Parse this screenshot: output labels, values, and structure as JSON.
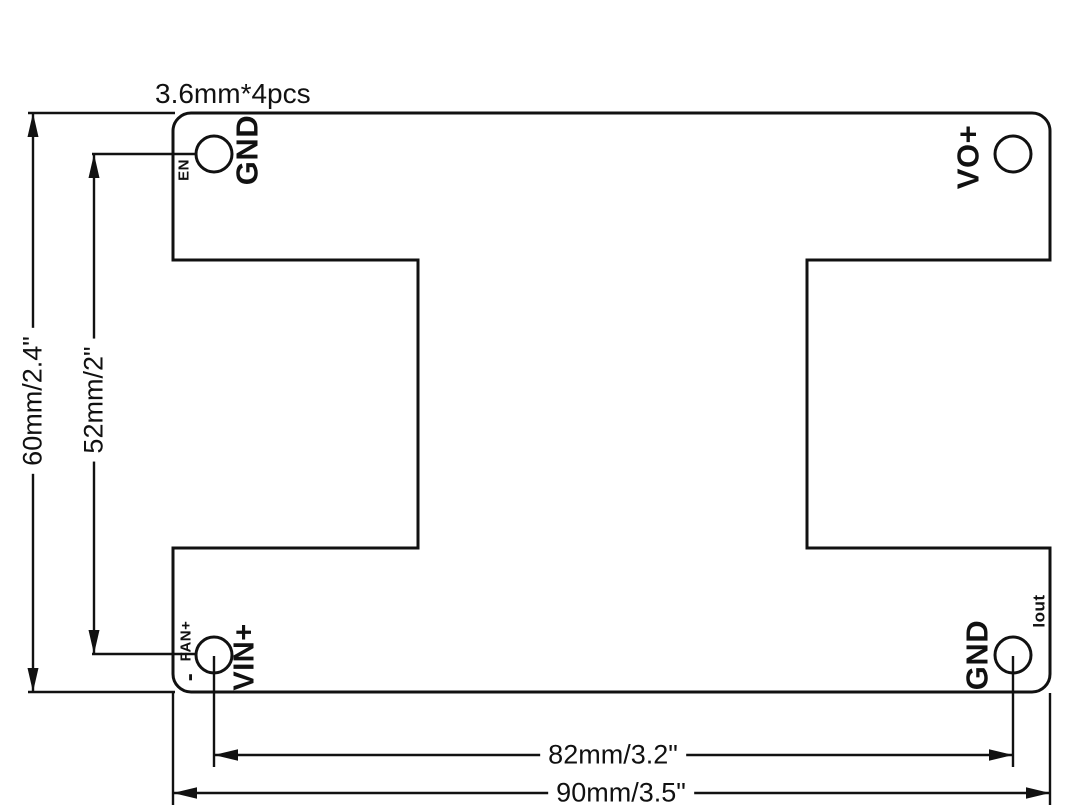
{
  "diagram": {
    "note_hole_size": "3.6mm*4pcs",
    "labels": {
      "en": "EN",
      "gnd_top": "GND",
      "vo_plus": "VO+",
      "fan_plus": "FAN+",
      "minus": "-",
      "vin_plus": "VIN+",
      "gnd_bottom": "GND",
      "iout": "Iout"
    },
    "dimensions": {
      "board_height": "60mm/2.4\"",
      "hole_pitch_vertical": "52mm/2\"",
      "hole_pitch_horizontal": "82mm/3.2\"",
      "board_width": "90mm/3.5\""
    },
    "colors": {
      "line": "#111111",
      "background": "#ffffff"
    }
  }
}
